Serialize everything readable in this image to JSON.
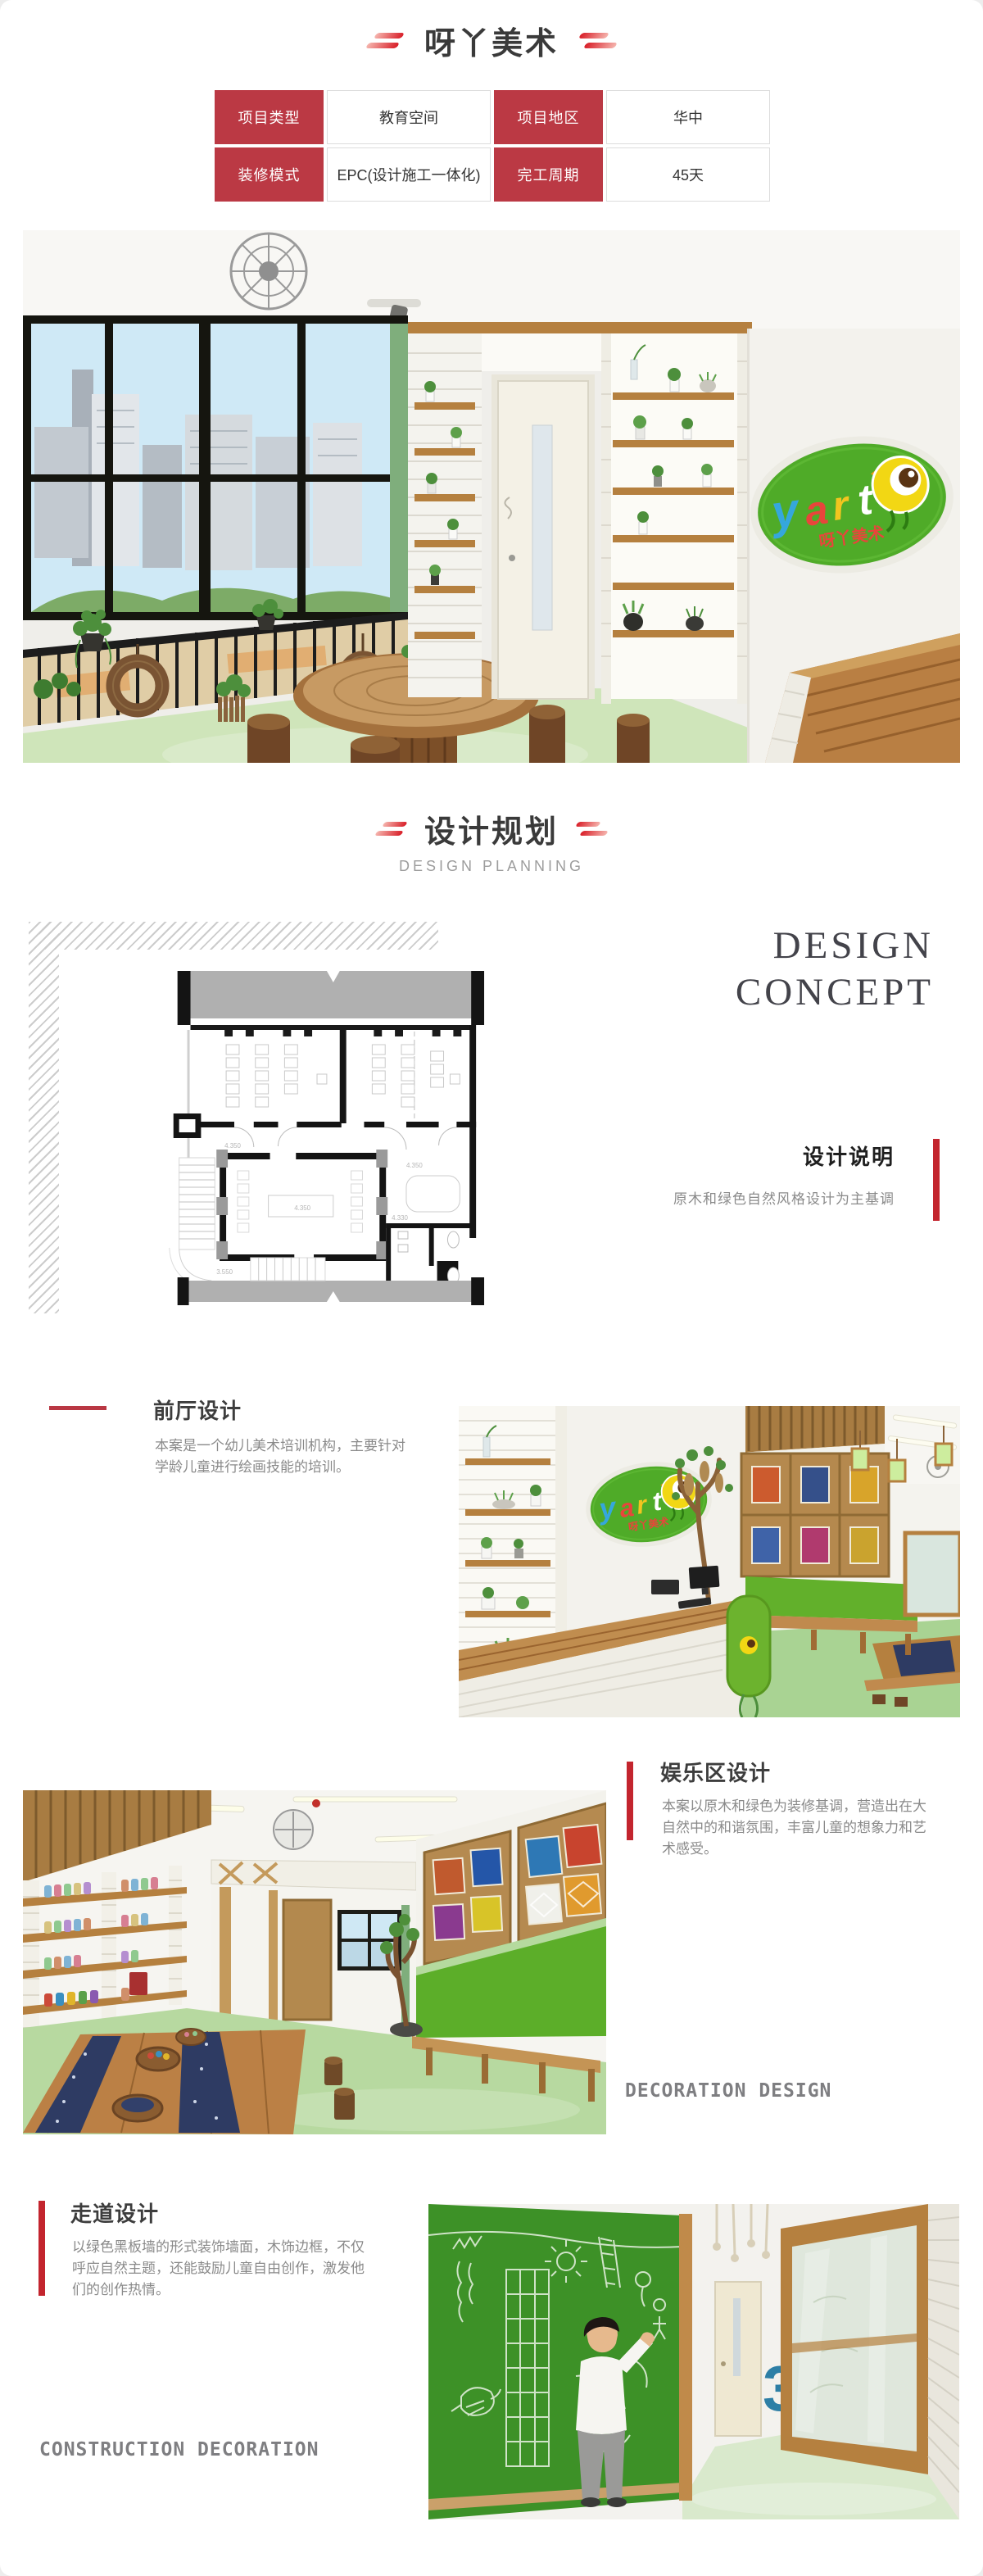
{
  "page": {
    "title": "呀丫美术"
  },
  "colors": {
    "brand_red": "#bb3944",
    "accent_red": "#c3252e",
    "logo_green": "#4fab28",
    "floor_green": "#cfe5ba"
  },
  "info_table": {
    "rows": [
      [
        {
          "label": "项目类型",
          "value": "教育空间"
        },
        {
          "label": "项目地区",
          "value": "华中"
        }
      ],
      [
        {
          "label": "装修模式",
          "value": "EPC(设计施工一体化)"
        },
        {
          "label": "完工周期",
          "value": "45天"
        }
      ]
    ]
  },
  "section_planning": {
    "title": "设计规划",
    "subtitle": "DESIGN PLANNING"
  },
  "design_concept": {
    "line1": "DESIGN",
    "line2": "CONCEPT",
    "note_title": "设计说明",
    "note_text": "原木和绿色自然风格设计为主基调"
  },
  "floor_plan": {
    "labels": [
      "4.350",
      "4.350",
      "4.350",
      "4.330",
      "3.550"
    ]
  },
  "section_front_hall": {
    "title": "前厅设计",
    "body": "本案是一个幼儿美术培训机构，主要针对学龄儿童进行绘画技能的培训。"
  },
  "section_play_area": {
    "title": "娱乐区设计",
    "body": "本案以原木和绿色为装修基调，营造出在大自然中的和谐氛围，丰富儿童的想象力和艺术感受。",
    "watermark": "DECORATION DESIGN"
  },
  "section_corridor": {
    "title": "走道设计",
    "body": "以绿色黑板墙的形式装饰墙面，木饰边框，不仅呼应自然主题，还能鼓励儿童自由创作，激发他们的创作热情。",
    "watermark": "CONSTRUCTION DECORATION"
  },
  "photos": {
    "logo_letters": [
      "y",
      "a",
      "r",
      "t"
    ],
    "logo_subtext": "呀丫美术",
    "corridor_number": "3"
  }
}
